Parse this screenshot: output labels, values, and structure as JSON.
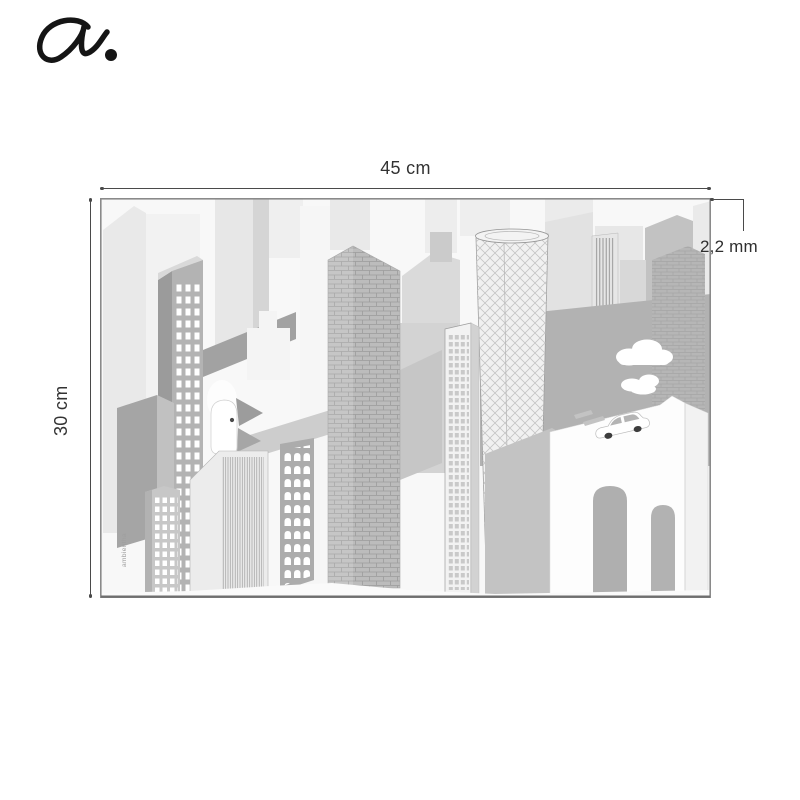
{
  "brand": {
    "logo_glyph": "a.",
    "watermark": "ambientha"
  },
  "dimensions": {
    "width_label": "45 cm",
    "height_label": "30 cm",
    "thickness_label": "2,2 mm"
  },
  "artwork": {
    "subject": "grayscale city skyline illustration with skyscrapers, clouds, car and rabbit figure"
  },
  "palette": {
    "background": "#ffffff",
    "dimension_line": "#4a4a4a",
    "label_text": "#333333",
    "logo_ink": "#151515",
    "mat_border": "#8a8a8a",
    "mat_bottom_edge": "#6f6f6f",
    "art_grays": [
      "#f8f8f8",
      "#ececec",
      "#d5d5d5",
      "#c4c4c4",
      "#b2b2b2",
      "#9c9c9c"
    ]
  }
}
